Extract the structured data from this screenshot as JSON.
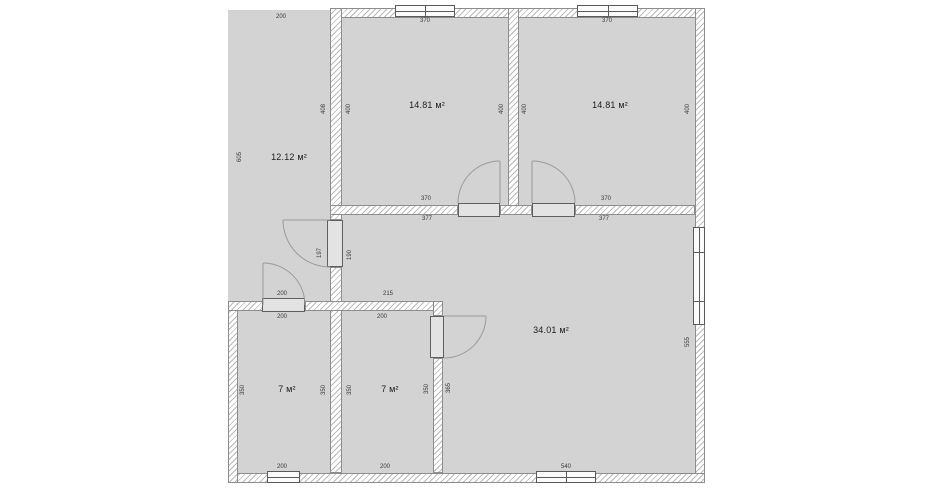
{
  "plan_title": "floor-plan",
  "colors": {
    "room_fill": "#d3d3d3",
    "wall_border": "#8d8d8d",
    "wall_hatch": "#b9b9b9",
    "door_line": "#9a9a9a",
    "label_text": "#3a3a3a"
  },
  "rooms": [
    {
      "id": "porch",
      "area_label": "12.12 м²"
    },
    {
      "id": "bedroom-1",
      "area_label": "14.81 м²"
    },
    {
      "id": "bedroom-2",
      "area_label": "14.81 м²"
    },
    {
      "id": "living-room",
      "area_label": "34.01 м²"
    },
    {
      "id": "kids-room-1",
      "area_label": "7 м²"
    },
    {
      "id": "kids-room-2",
      "area_label": "7 м²"
    }
  ],
  "dims": {
    "porch_top": "200",
    "porch_left": "605",
    "bed1_window_top": "370",
    "bed2_window_top": "370",
    "bed1_wall_left_outer": "408",
    "bed1_left": "400",
    "bed1_right": "400",
    "bed2_left": "400",
    "bed2_right": "400",
    "bed1_bottom": "370",
    "bed2_bottom": "370",
    "bed1_bottom_outer": "377",
    "bed2_bottom_outer": "377",
    "hall_door_side_a": "197",
    "hall_door_side_b": "190",
    "porch_door_top": "200",
    "living_wall_left": "215",
    "kid1_top": "200",
    "kid2_top": "200",
    "kid1_left": "350",
    "kid1_right": "350",
    "kid2_left": "350",
    "kid2_right": "350",
    "kid2_wall_outer": "365",
    "kid1_bottom": "200",
    "kid2_bottom": "200",
    "living_window_right": "555",
    "living_window_bottom": "540"
  }
}
